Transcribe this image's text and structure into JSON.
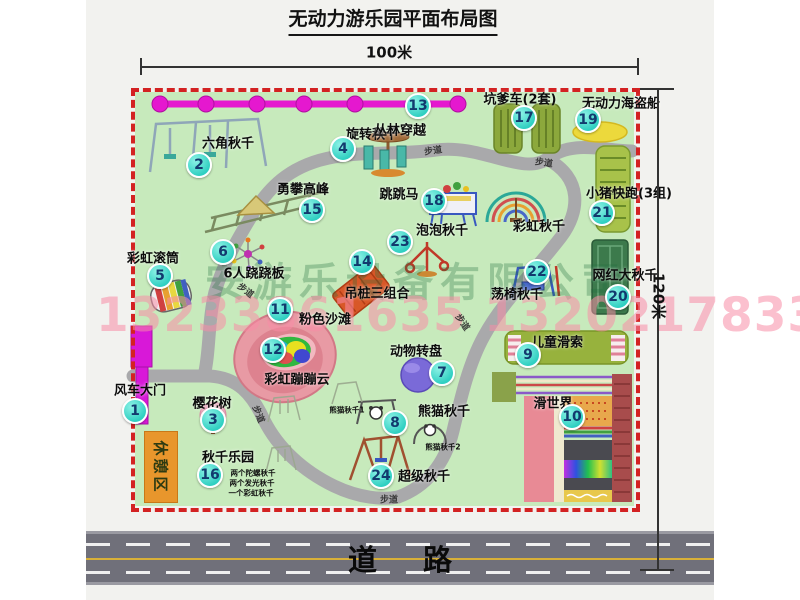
{
  "title": "无动力游乐园平面布局图",
  "dimensions": {
    "width_label": "100米",
    "height_label": "120米"
  },
  "road": {
    "label": "道路"
  },
  "watermark": {
    "company": "安游乐设备有限公司",
    "phone": "13233861635 13202178333"
  },
  "rest_area_label": "休憩区",
  "colors": {
    "map_green": "#c7eabc",
    "border_red": "#d32222",
    "badge_teal": "#2fcfc1",
    "path_gray": "#a9a9ab",
    "gate_magenta": "#d818d8",
    "road_gray": "#70707a",
    "rest_orange": "#e8962c"
  },
  "map": {
    "attractions": [
      {
        "num": "1",
        "label": "风车大门",
        "bx": 135,
        "by": 411,
        "lx": 140,
        "ly": 389
      },
      {
        "num": "2",
        "label": "六角秋千",
        "bx": 199,
        "by": 165,
        "lx": 228,
        "ly": 142
      },
      {
        "num": "3",
        "label": "樱花树",
        "bx": 213,
        "by": 420,
        "lx": 212,
        "ly": 402
      },
      {
        "num": "4",
        "label": "旋转秋千",
        "bx": 343,
        "by": 149,
        "lx": 372,
        "ly": 133
      },
      {
        "num": "5",
        "label": "彩虹滚筒",
        "bx": 160,
        "by": 276,
        "lx": 153,
        "ly": 257
      },
      {
        "num": "6",
        "label": "6人跷跷板",
        "bx": 223,
        "by": 252,
        "lx": 254,
        "ly": 272
      },
      {
        "num": "7",
        "label": "动物转盘",
        "bx": 442,
        "by": 373,
        "lx": 416,
        "ly": 350
      },
      {
        "num": "8",
        "label": "熊猫秋千",
        "bx": 395,
        "by": 423,
        "lx": 444,
        "ly": 410
      },
      {
        "num": "9",
        "label": "儿童滑索",
        "bx": 528,
        "by": 355,
        "lx": 557,
        "ly": 341
      },
      {
        "num": "10",
        "label": "滑世界",
        "bx": 572,
        "by": 417,
        "lx": 553,
        "ly": 402
      },
      {
        "num": "11",
        "label": "粉色沙滩",
        "bx": 280,
        "by": 310,
        "lx": 325,
        "ly": 318
      },
      {
        "num": "12",
        "label": "彩虹蹦蹦云",
        "bx": 273,
        "by": 350,
        "lx": 297,
        "ly": 378
      },
      {
        "num": "13",
        "label": "丛林穿越",
        "bx": 418,
        "by": 106,
        "lx": 400,
        "ly": 129
      },
      {
        "num": "14",
        "label": "吊桩三组合",
        "bx": 362,
        "by": 262,
        "lx": 377,
        "ly": 292
      },
      {
        "num": "15",
        "label": "勇攀高峰",
        "bx": 312,
        "by": 210,
        "lx": 303,
        "ly": 188
      },
      {
        "num": "16",
        "label": "秋千乐园",
        "bx": 210,
        "by": 475,
        "lx": 228,
        "ly": 456
      },
      {
        "num": "17",
        "label": "坑爹车(2套)",
        "bx": 524,
        "by": 118,
        "lx": 520,
        "ly": 98
      },
      {
        "num": "18",
        "label": "跳跳马",
        "bx": 434,
        "by": 201,
        "lx": 399,
        "ly": 193
      },
      {
        "num": "19",
        "label": "无动力海盗船",
        "bx": 588,
        "by": 120,
        "lx": 621,
        "ly": 102
      },
      {
        "num": "20",
        "label": "网红大秋千",
        "bx": 618,
        "by": 297,
        "lx": 625,
        "ly": 274
      },
      {
        "num": "21",
        "label": "小猪快跑(3组)",
        "bx": 602,
        "by": 213,
        "lx": 629,
        "ly": 192
      },
      {
        "num": "22",
        "label": "荡椅秋千",
        "bx": 537,
        "by": 272,
        "lx": 517,
        "ly": 293
      },
      {
        "num": "23",
        "label": "泡泡秋千",
        "bx": 400,
        "by": 242,
        "lx": 442,
        "ly": 229
      },
      {
        "num": "24",
        "label": "超级秋千",
        "bx": 381,
        "by": 476,
        "lx": 424,
        "ly": 475
      },
      {
        "num": null,
        "label": "彩虹秋千",
        "bx": null,
        "by": null,
        "lx": 539,
        "ly": 225
      }
    ],
    "sub_labels": [
      {
        "text": "熊猫秋千1",
        "x": 347,
        "y": 410
      },
      {
        "text": "熊猫秋千2",
        "x": 443,
        "y": 447
      },
      {
        "text": "两个陀螺秋千",
        "x": 253,
        "y": 473
      },
      {
        "text": "两个发光秋千",
        "x": 252,
        "y": 483
      },
      {
        "text": "一个彩虹秋千",
        "x": 251,
        "y": 493
      }
    ],
    "walkway_label": "步道",
    "walkway_positions": [
      {
        "x": 433,
        "y": 150,
        "rot": -8
      },
      {
        "x": 544,
        "y": 162,
        "rot": 8
      },
      {
        "x": 246,
        "y": 290,
        "rot": 38
      },
      {
        "x": 259,
        "y": 414,
        "rot": 68
      },
      {
        "x": 389,
        "y": 499,
        "rot": 0
      },
      {
        "x": 463,
        "y": 322,
        "rot": 55
      }
    ]
  }
}
